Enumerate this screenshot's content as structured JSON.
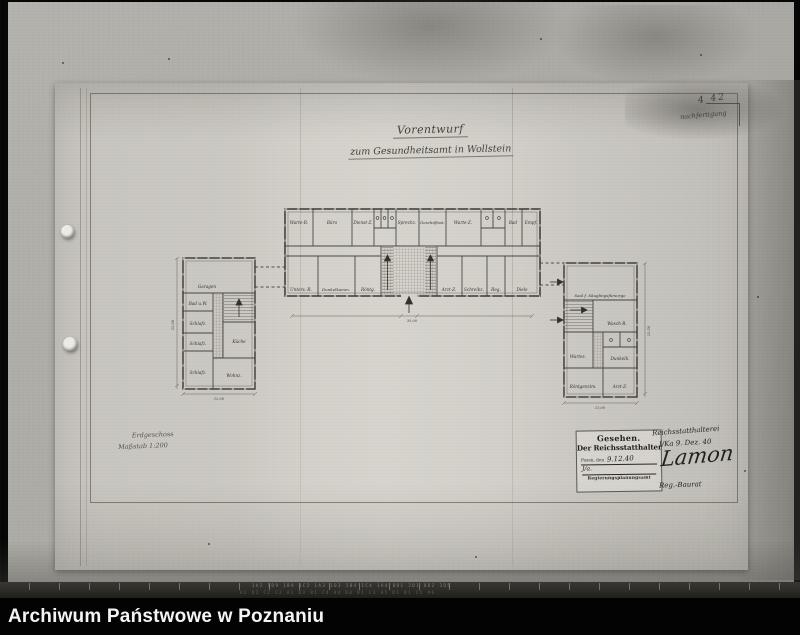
{
  "footer": {
    "label": "Archiwum Państwowe w Poznaniu"
  },
  "film_strip": {
    "codes_row1": "1A2 1D9 1B9 1C2 1A3 1D3 1B4 1C4 1A4 8D1 2D1 8D2 3D5",
    "codes_row2": "A2 D2 C2 C2 A1 D3 B1 C4 A4 D4 B1 C3 A5 D1 B1 C5 A6"
  },
  "annotations": {
    "corner_number": "4 42",
    "mount_note": "nachfertigung",
    "scale_line1": "Erdgeschoss",
    "scale_line2": "Maßstab 1:200"
  },
  "title": {
    "line1": "Vorentwurf",
    "line2": "zum Gesundheitsamt in Wollstein"
  },
  "stamp": {
    "gesehen": "Gesehen.",
    "authority": "Der Reichsstatthalter",
    "place": "Posen, den",
    "date": "9.12.40",
    "initials": "J/a.",
    "office": "Regierungsplanungsamt"
  },
  "signatures": {
    "line1": "Reichsstatthalterei",
    "line2": "I/Ka 9. Dez. 40",
    "name": "Lamon",
    "line3": "Reg.-Baurat"
  },
  "plan": {
    "center_top_rooms": [
      "Warte-R.",
      "Büro",
      "Dienst-Z.",
      "Sprechz.",
      "Geschäftsst.",
      "Warte-Z.",
      "Bad",
      "Empf."
    ],
    "center_bottom_rooms": [
      "Unters.-R.",
      "Dunkelkamm.",
      "Röntg.",
      "Arzt-Z.",
      "Schreibz.",
      "Reg.",
      "Diele"
    ],
    "center_dim": "35,00",
    "left_annex": {
      "garage": "Garagen",
      "bad": "Bad u.W.",
      "schlaf1": "Schlafz.",
      "schlaf2": "Schlafz.",
      "schlaf3": "Schlafz.",
      "kueche": "Küche",
      "wohnen": "Wohnz.",
      "dim_bottom": "12,00",
      "dim_left": "22,00"
    },
    "right_annex": {
      "hall": "Saal f. Säuglingsfürsorge",
      "wasch": "Wasch-R.",
      "warte": "Wartez.",
      "dunkel": "Dunkelk.",
      "roentgen": "Röntgenzim.",
      "arzt": "Arzt-Z.",
      "dim_bottom": "12,00",
      "dim_right": "22,50"
    }
  }
}
